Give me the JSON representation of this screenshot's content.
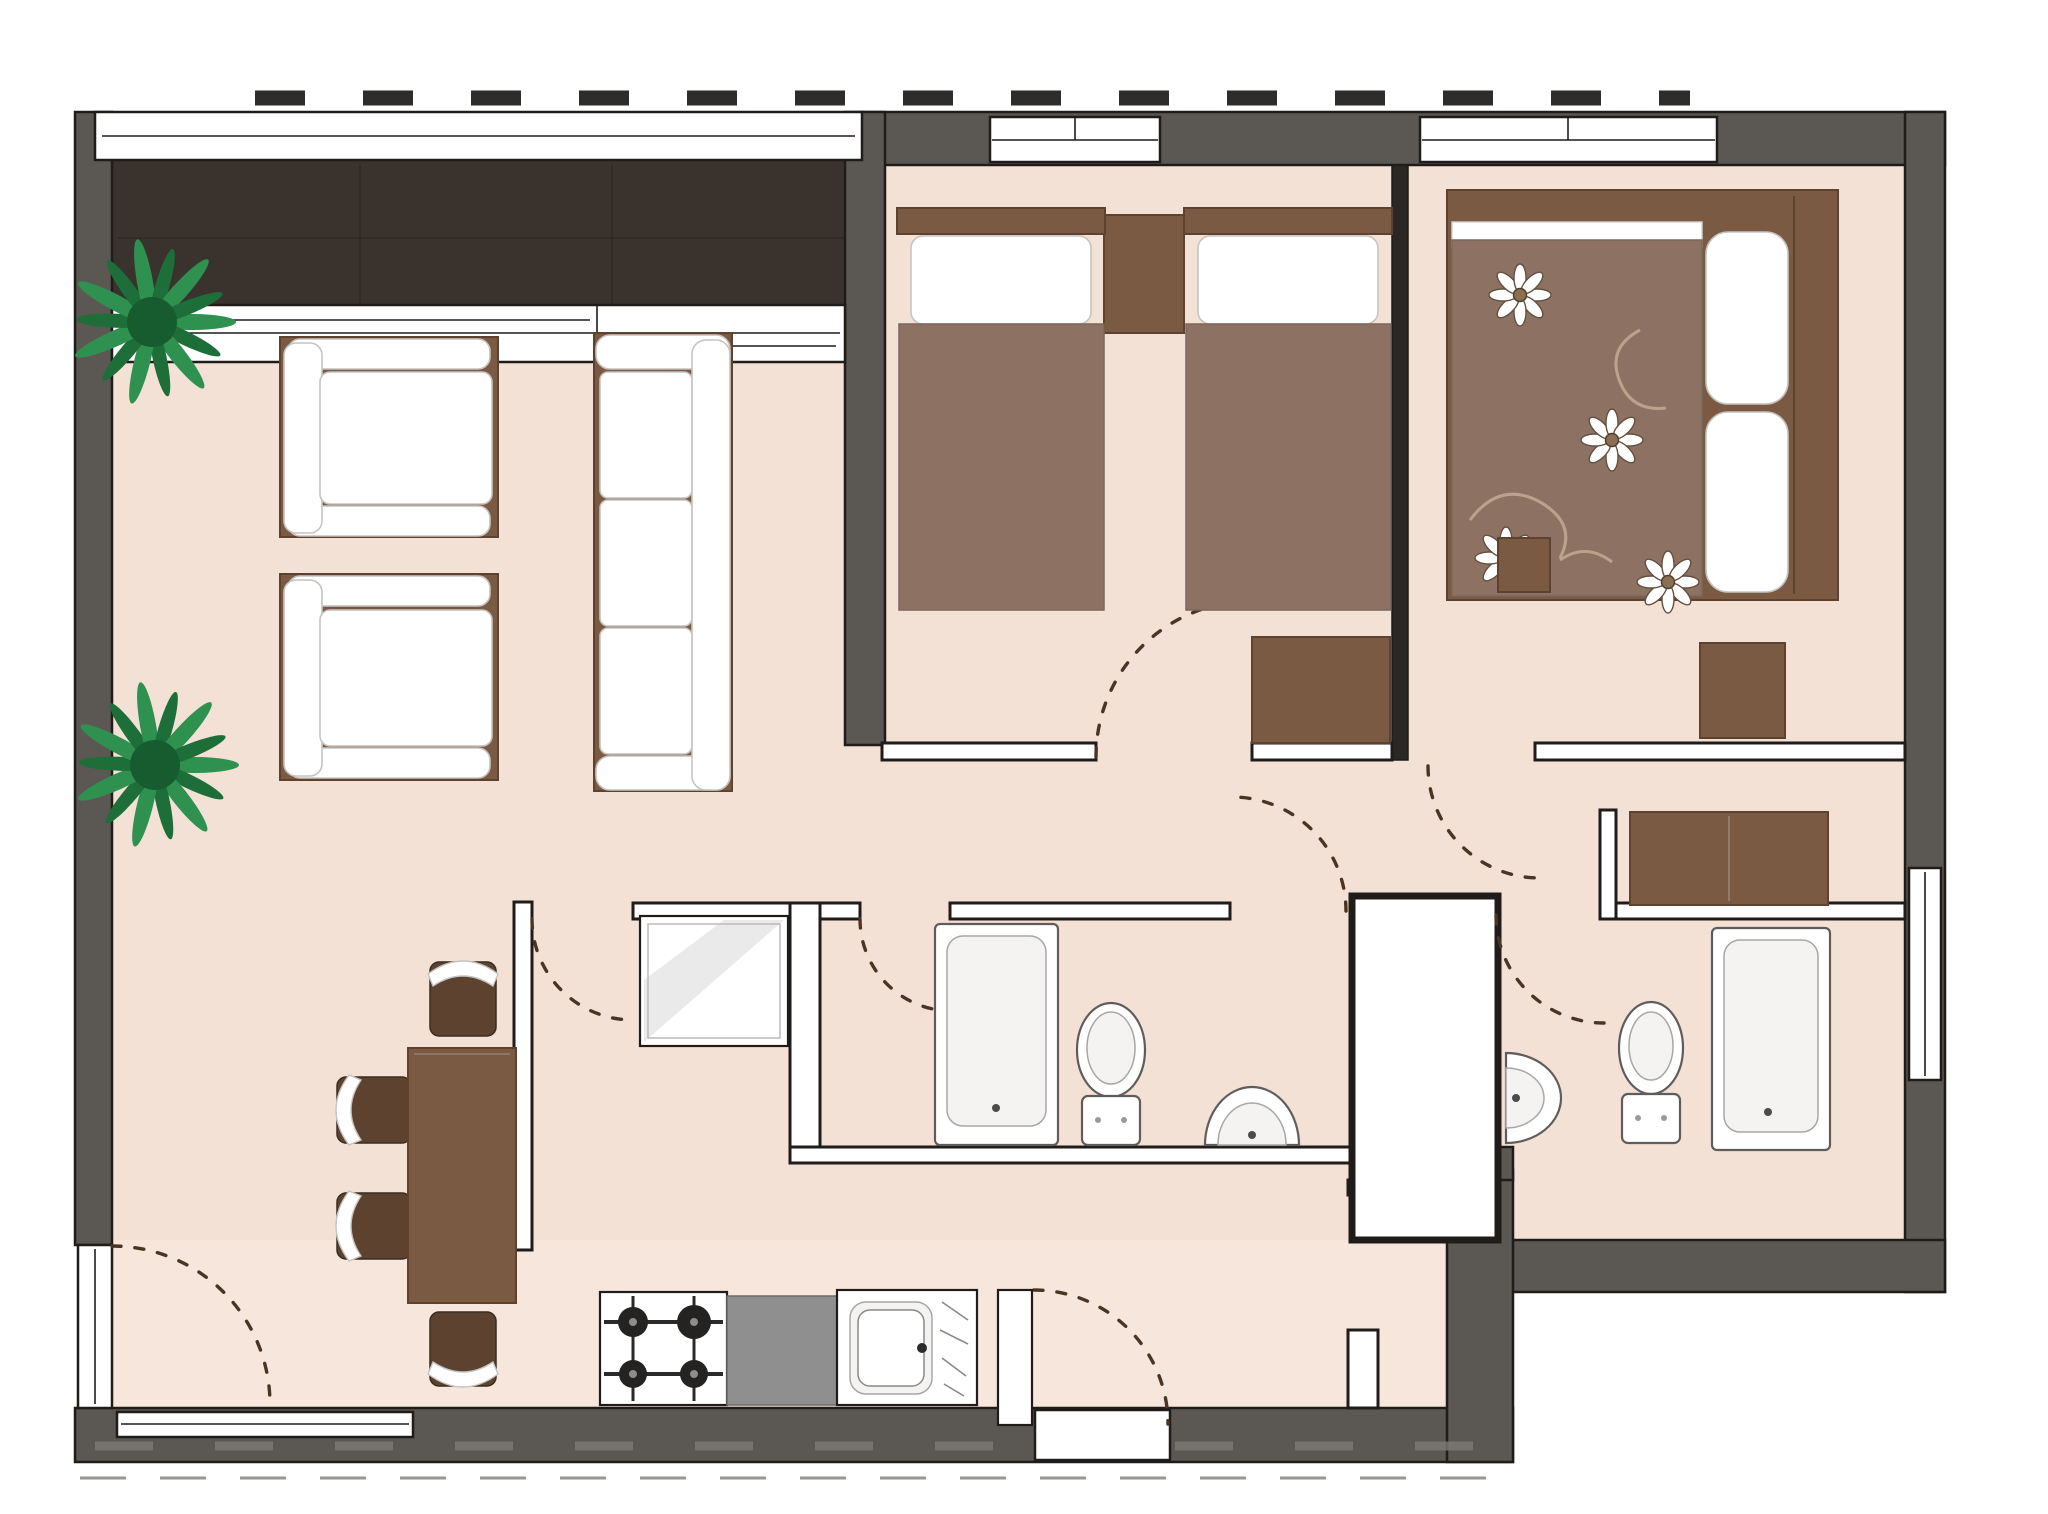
{
  "title": "apartment floor plan (top view render)",
  "colors": {
    "wall": "#5b5752",
    "darkwall": "#2b2724",
    "outline": "#1f1c19",
    "floor": "#f4e1d6",
    "floor2": "#f6e6dc",
    "balcony": "#3a322c",
    "brown": "#7b5a43",
    "brownDark": "#5d4230",
    "duvet": "#8d7263",
    "counter": "#8f8f8f",
    "plantA": "#2f9150",
    "plantB": "#1d6e38",
    "arc": "#4a3423",
    "dash": "#2e2d2c"
  },
  "plan": {
    "rooms": [
      {
        "name": "balcony",
        "items": []
      },
      {
        "name": "living-dining-room",
        "items": [
          "sofa",
          "armchair",
          "armchair",
          "dining-table",
          "dining-chair x4",
          "plant x2"
        ]
      },
      {
        "name": "kitchen",
        "items": [
          "stove",
          "counter",
          "sink",
          "refrigerator",
          "service-door"
        ]
      },
      {
        "name": "bedroom-twin",
        "items": [
          "single-bed x2",
          "nightstand",
          "desk"
        ]
      },
      {
        "name": "bedroom-master",
        "items": [
          "double-bed",
          "nightstand",
          "stool",
          "wardrobe"
        ]
      },
      {
        "name": "bathroom-1",
        "items": [
          "bathtub",
          "toilet",
          "wash-basin"
        ]
      },
      {
        "name": "bathroom-2",
        "items": [
          "bathtub",
          "toilet",
          "wash-basin"
        ]
      },
      {
        "name": "hall",
        "items": []
      },
      {
        "name": "entry-corridor",
        "items": []
      },
      {
        "name": "duct-shaft",
        "items": []
      }
    ],
    "door_swings": 8,
    "windows": [
      "top-wall x2",
      "balcony-slider",
      "right-wall",
      "bottom-wall",
      "left-wall-door-light"
    ]
  }
}
